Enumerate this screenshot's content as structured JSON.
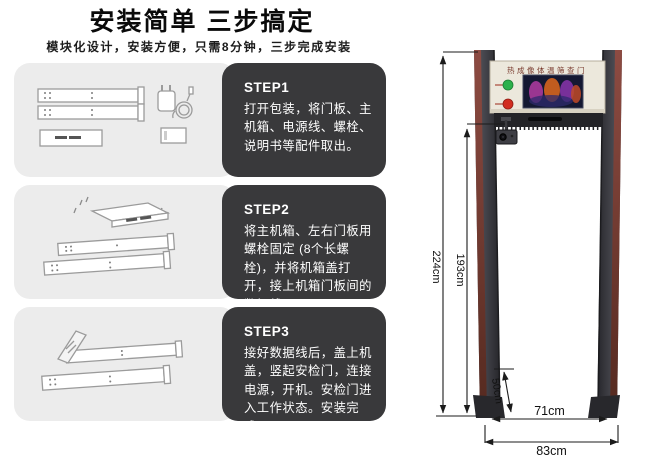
{
  "header": {
    "title": "安装简单 三步搞定",
    "subtitle": "模块化设计，安装方便，只需8分钟，三步完成安装"
  },
  "steps": [
    {
      "label": "STEP1",
      "text": "打开包装，将门板、主机箱、电源线、螺栓、说明书等配件取出。"
    },
    {
      "label": "STEP2",
      "text": "将主机箱、左右门板用螺栓固定 (8个长螺栓)，并将机箱盖打开，接上机箱门板间的数据线。"
    },
    {
      "label": "STEP3",
      "text": "接好数据线后，盖上机盖，竖起安检门，连接电源，开机。安检门进入工作状态。安装完成。"
    }
  ],
  "door": {
    "nameplate": "热成像体温筛查门",
    "dimensions": {
      "total_height": "224cm",
      "opening_height": "193cm",
      "base_section": "50cm",
      "inner_width": "71cm",
      "outer_width": "83cm"
    },
    "colors": {
      "pillar": "#3f3f46",
      "pillar_stripe": "#7d4038",
      "panel": "#ece8dc",
      "indicator_green": "#2cb14c",
      "indicator_red": "#d22d20",
      "card_dark": "#39393b",
      "card_light": "#ececec"
    }
  }
}
